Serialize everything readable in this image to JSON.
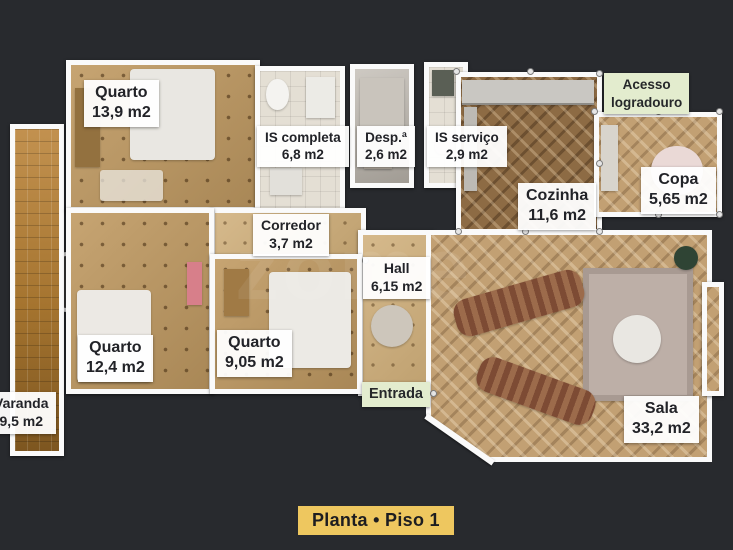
{
  "title": {
    "label": "Planta • Piso 1"
  },
  "watermark": {
    "text": "zome"
  },
  "colors": {
    "background": "#282a2e",
    "wall": "#fafafa",
    "room_label_bg": "#ffffff",
    "room_label_text": "#222328",
    "green_label_bg": "#e3ecce",
    "title_bg": "#eec75f",
    "title_text": "#1d1d20"
  },
  "rooms": [
    {
      "id": "quarto-1",
      "name": "Quarto",
      "area": "13,9 m2"
    },
    {
      "id": "is-completa",
      "name": "IS completa",
      "area": "6,8 m2"
    },
    {
      "id": "despensa",
      "name": "Desp.ª",
      "area": "2,6 m2"
    },
    {
      "id": "is-servico",
      "name": "IS serviço",
      "area": "2,9 m2"
    },
    {
      "id": "cozinha",
      "name": "Cozinha",
      "area": "11,6 m2"
    },
    {
      "id": "copa",
      "name": "Copa",
      "area": "5,65 m2"
    },
    {
      "id": "corredor",
      "name": "Corredor",
      "area": "3,7 m2"
    },
    {
      "id": "hall",
      "name": "Hall",
      "area": "6,15 m2"
    },
    {
      "id": "quarto-2",
      "name": "Quarto",
      "area": "12,4 m2"
    },
    {
      "id": "quarto-3",
      "name": "Quarto",
      "area": "9,05 m2"
    },
    {
      "id": "sala",
      "name": "Sala",
      "area": "33,2 m2"
    },
    {
      "id": "varanda",
      "name": "Varanda",
      "area": "9,5 m2"
    }
  ],
  "annotations": {
    "acesso": {
      "line1": "Acesso",
      "line2": "logradouro"
    },
    "entrada": {
      "label": "Entrada"
    }
  }
}
